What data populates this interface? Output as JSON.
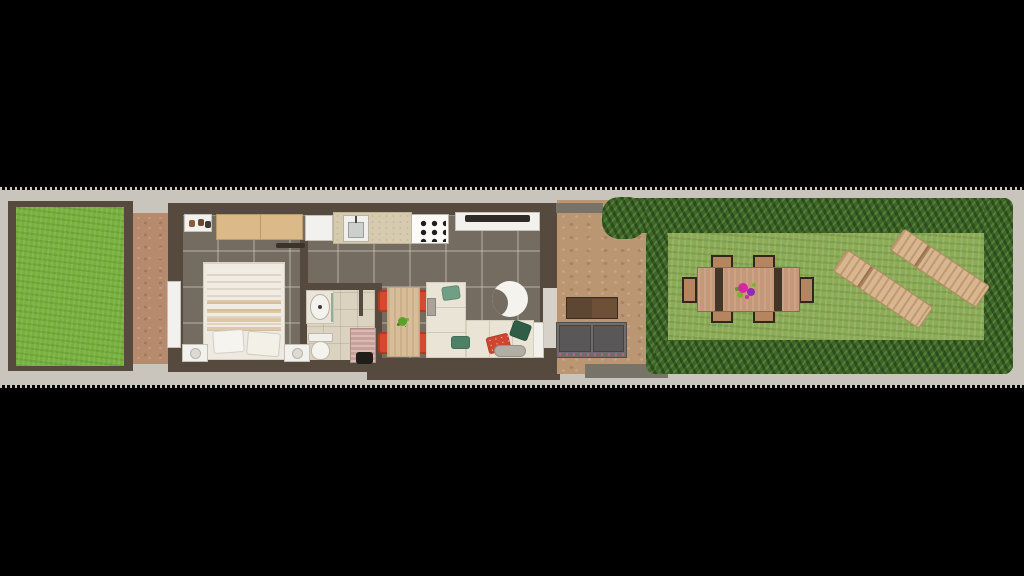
{
  "scene": {
    "type": "3d-rendered top-down floor plan",
    "description": "Long narrow single-storey home with front lawn, entry path, bedroom, bathroom, open kitchen-dining-living space, paved patio and hedge-enclosed back garden",
    "letterboxed": true
  },
  "colors": {
    "background": "#000000",
    "plot_band": "#c9c5bd",
    "wall": "#564a3e",
    "stub_wall": "#787369",
    "tile_floor": "#746b61",
    "bathroom_floor": "#dbd2bf",
    "front_lawn": "#79b13e",
    "back_lawn": "#8cab57",
    "hedge": "#3e6629",
    "path": "#b68a6c",
    "patio": "#bb9673",
    "wardrobe": "#dcb988",
    "counter": "#d6cbae",
    "dining_table": "#d7bd99",
    "chair_red": "#d6492f",
    "sofa": "#eae4d6",
    "bed": "#efeae1",
    "outdoor_sofa": "#6f6c6b",
    "coffee_table": "#5d4632",
    "lounger": "#d9b68f",
    "garden_table": "#c49878",
    "door": "#f2f1ed",
    "flower": "#d6289e",
    "plant": "#58a22b"
  },
  "areas": [
    {
      "name": "front-garden",
      "contents": [
        "lawn"
      ]
    },
    {
      "name": "entry-path",
      "contents": [
        "cobblestone walkway"
      ]
    },
    {
      "name": "bedroom",
      "contents": [
        "double bed",
        "wardrobe",
        "shoe mat",
        "radiator",
        "two bedside mats with stools",
        "entrance door"
      ]
    },
    {
      "name": "bathroom",
      "contents": [
        "vanity sink",
        "toilet",
        "shower mat",
        "shower fixture",
        "partition wall"
      ]
    },
    {
      "name": "kitchen",
      "contents": [
        "fridge",
        "counter with sink",
        "gas hob",
        "media console with tv"
      ]
    },
    {
      "name": "dining-area",
      "contents": [
        "wood table",
        "four red chairs",
        "potted plant centerpiece"
      ]
    },
    {
      "name": "living-room",
      "contents": [
        "l-shaped cream sofa",
        "throw pillows",
        "ottoman",
        "crescent rug",
        "side table",
        "patio door"
      ]
    },
    {
      "name": "patio",
      "contents": [
        "cobblestone paving",
        "outdoor grey sofa",
        "dark wood coffee table",
        "wall stubs"
      ]
    },
    {
      "name": "back-garden",
      "contents": [
        "hedge border",
        "lawn",
        "outdoor dining table with six chairs",
        "flower centerpiece",
        "two wooden sun loungers"
      ]
    }
  ]
}
